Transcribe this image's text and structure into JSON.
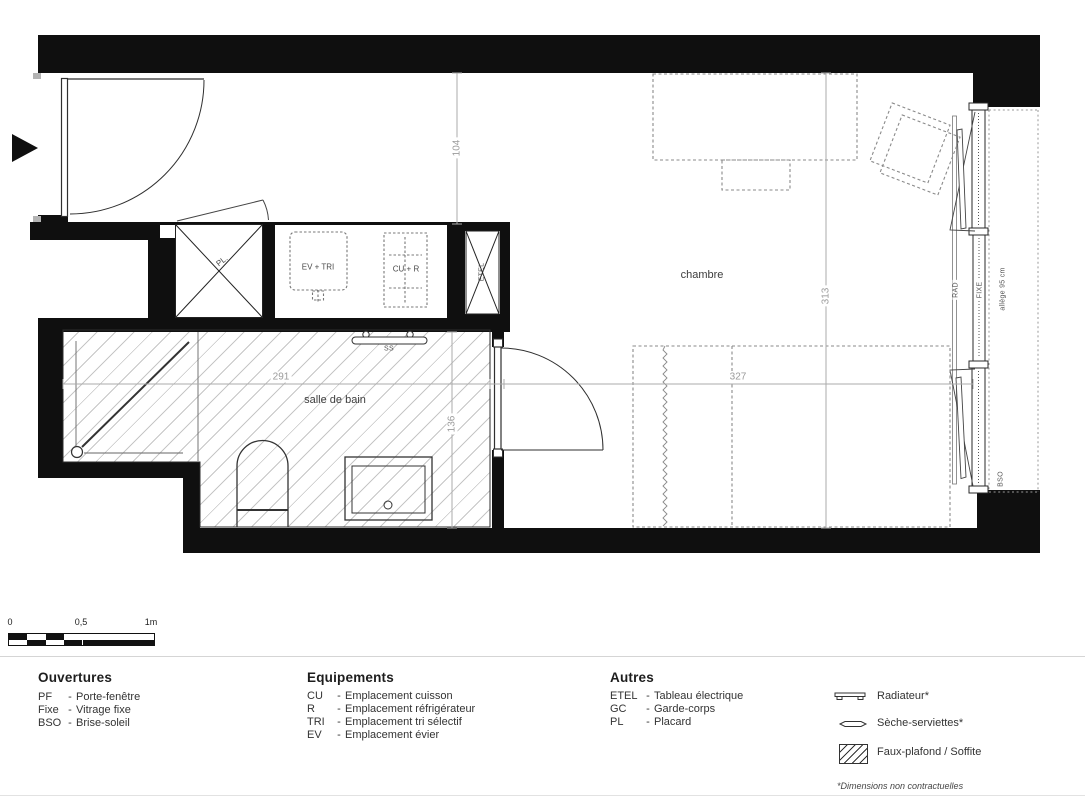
{
  "colors": {
    "wall": "#0f0f0f",
    "dim_line": "#ababab",
    "dim_text": "#9b9b9b",
    "hatch_line": "#c6c6c6",
    "furniture_dash": "#8a8a8a"
  },
  "plan": {
    "room_labels": {
      "bedroom": "chambre",
      "bathroom": "salle de bain"
    },
    "fixture_labels": {
      "closet": "PL.",
      "electrical_panel": "ETEL",
      "towel_dryer": "SS",
      "sink_sorting": "EV + TRI",
      "cooking_fridge": "CU + R",
      "radiator": "RAD",
      "fixed_glazing": "FIXE",
      "sill": "allège 95 cm",
      "sun_shade": "BSO"
    },
    "dimensions": {
      "entry_depth_cm": "104",
      "room_depth_cm": "313",
      "bathroom_width_cm": "291",
      "bedroom_width_cm": "327",
      "bathroom_depth_cm": "136"
    }
  },
  "scale_bar": {
    "tick_0": "0",
    "tick_half": "0,5",
    "tick_1m": "1m"
  },
  "legend": {
    "separator": "-",
    "openings": {
      "title": "Ouvertures",
      "items": [
        {
          "abbr": "PF",
          "label": "Porte-fenêtre"
        },
        {
          "abbr": "Fixe",
          "label": "Vitrage fixe"
        },
        {
          "abbr": "BSO",
          "label": "Brise-soleil"
        }
      ]
    },
    "equipment": {
      "title": "Equipements",
      "items": [
        {
          "abbr": "CU",
          "label": "Emplacement cuisson"
        },
        {
          "abbr": "R",
          "label": "Emplacement réfrigérateur"
        },
        {
          "abbr": "TRI",
          "label": "Emplacement tri sélectif"
        },
        {
          "abbr": "EV",
          "label": "Emplacement évier"
        }
      ]
    },
    "others": {
      "title": "Autres",
      "items": [
        {
          "abbr": "ETEL",
          "label": "Tableau électrique"
        },
        {
          "abbr": "GC",
          "label": "Garde-corps"
        },
        {
          "abbr": "PL",
          "label": "Placard"
        }
      ]
    },
    "symbols": [
      {
        "name": "radiator",
        "label": "Radiateur*"
      },
      {
        "name": "towel-dryer",
        "label": "Sèche-serviettes*"
      },
      {
        "name": "false-ceiling",
        "label": "Faux-plafond / Soffite"
      }
    ],
    "footnote": "*Dimensions non contractuelles"
  }
}
